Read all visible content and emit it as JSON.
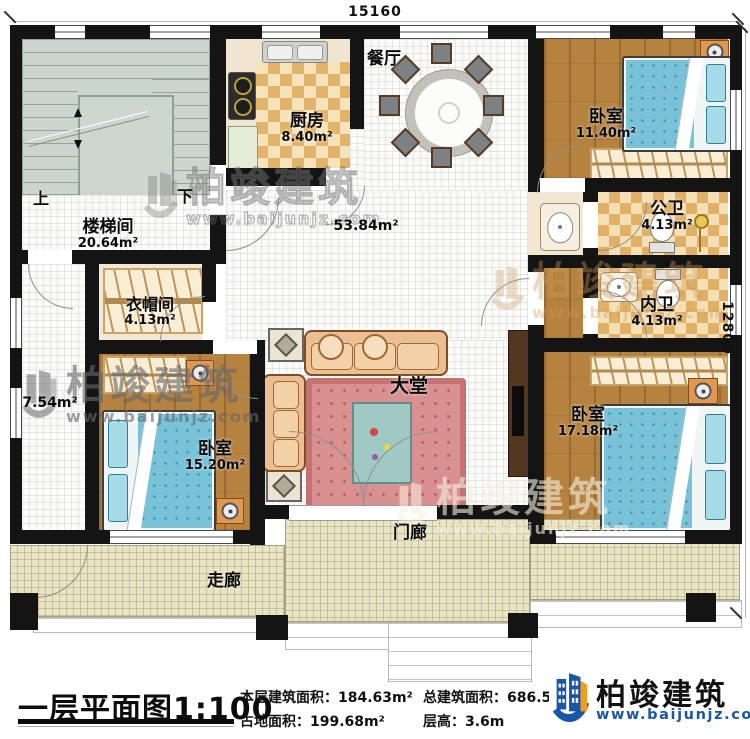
{
  "dimensions": {
    "top": "15160",
    "right": "12800"
  },
  "rooms": {
    "staircase": {
      "name": "楼梯间",
      "area": "20.64m²"
    },
    "stairs_up": "上",
    "stairs_down": "下",
    "kitchen": {
      "name": "厨房",
      "area": "8.40m²"
    },
    "dining": {
      "name": "餐厅"
    },
    "bedroom_top": {
      "name": "卧室",
      "area": "11.40m²"
    },
    "public_bath": {
      "name": "公卫",
      "area": "4.13m²"
    },
    "inner_bath": {
      "name": "内卫",
      "area": "4.13m²"
    },
    "hall": {
      "name": "大堂",
      "area": "53.84m²"
    },
    "cloakroom": {
      "name": "衣帽间",
      "area": "4.13m²"
    },
    "bedroom_left": {
      "name": "卧室",
      "area": "15.20m²"
    },
    "bedroom_right": {
      "name": "卧室",
      "area": "17.18m²"
    },
    "side_area": {
      "area": "7.54m²"
    },
    "porch": {
      "name": "门廊"
    },
    "corridor": {
      "name": "走廊"
    }
  },
  "title_block": {
    "title": "一层平面图1:100",
    "stats": [
      {
        "label": "本层建筑面积：",
        "value": "184.63m²"
      },
      {
        "label": "占地面积：",
        "value": "199.68m²"
      },
      {
        "label": "总建筑面积：",
        "value": "686.50"
      },
      {
        "label": "层高：",
        "value": "3.6m"
      }
    ]
  },
  "branding": {
    "name": "柏竣建筑",
    "url": "www.baijunjz.com"
  },
  "watermark": {
    "text": "柏竣建筑",
    "url": "www.baijunjz.com"
  },
  "colors": {
    "wall": "#141414",
    "wood_floor": "#b5823f",
    "checker_tan": "#e2b36a",
    "bed_blue": "#79c2d8",
    "porch_tile": "#eae4c6",
    "brand_blue": "#1a56a8",
    "brand_orange": "#f29b1d"
  }
}
